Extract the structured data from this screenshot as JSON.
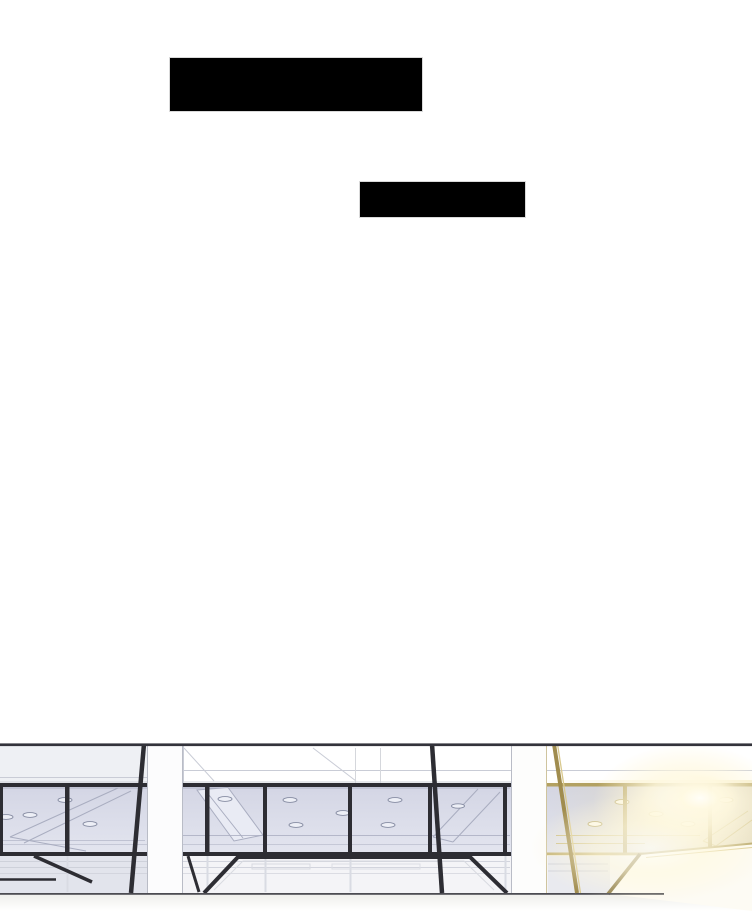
{
  "page": {
    "type": "webtoon-panel",
    "background_color": "#ffffff",
    "width": 752,
    "height": 911
  },
  "censor_boxes": [
    {
      "label": "blacked-out-caption-1",
      "x": 169,
      "y": 57,
      "width": 254,
      "height": 55,
      "color": "#000000",
      "border_color": "#d9d9d9"
    },
    {
      "label": "blacked-out-caption-2",
      "x": 359,
      "y": 181,
      "width": 167,
      "height": 37,
      "color": "#000000",
      "border_color": "#d9d9d9"
    }
  ],
  "illustration": {
    "description": "Line-art elevation of a modern glass curtain-wall interior: white ceiling fascia, lavender-tinted window band with recessed ceiling lights and angled skylight panels, white structural pillars, dark diagonal braces, angular desk silhouettes below, and a warm golden sunlight flare washing the right side",
    "top": 740,
    "height": 171,
    "palette": {
      "frame-dark": "#2d2d33",
      "glass-top": "#d3d5e4",
      "glass-bottom": "#e3e5ef",
      "line-light": "#a9adc0",
      "line-faint": "#c9ccd6",
      "fascia-gray": "#eef0f4",
      "lower-band": "#f4f4f7",
      "lower-glass": "#e2e4ec",
      "gold-frame": "#b3a161",
      "gold-light": "#d9c98e",
      "gold-desk": "#8d7c48",
      "ground": "#4c4c52",
      "pillar-white": "#fcfcfd",
      "pillar-edge": "#b9bcc6",
      "censor": "#000000",
      "censor-edge": "#d9d9d9"
    }
  }
}
